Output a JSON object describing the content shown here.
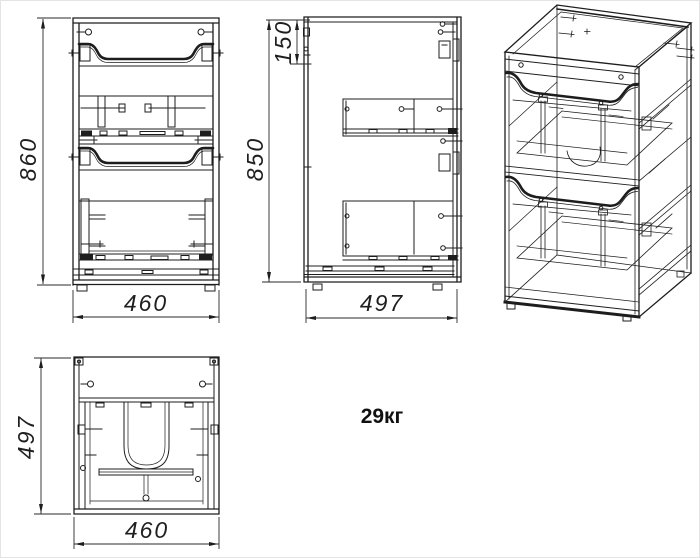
{
  "drawing": {
    "weight_label": "29кг",
    "views": {
      "front": {
        "dim_height": "860",
        "dim_width": "460"
      },
      "side": {
        "dim_top_offset": "150",
        "dim_height": "850",
        "dim_depth": "497"
      },
      "plan": {
        "dim_depth": "497",
        "dim_width": "460"
      }
    },
    "colors": {
      "line": "#1d1d1d",
      "background": "#ffffff",
      "text": "#1f1f1f"
    }
  }
}
